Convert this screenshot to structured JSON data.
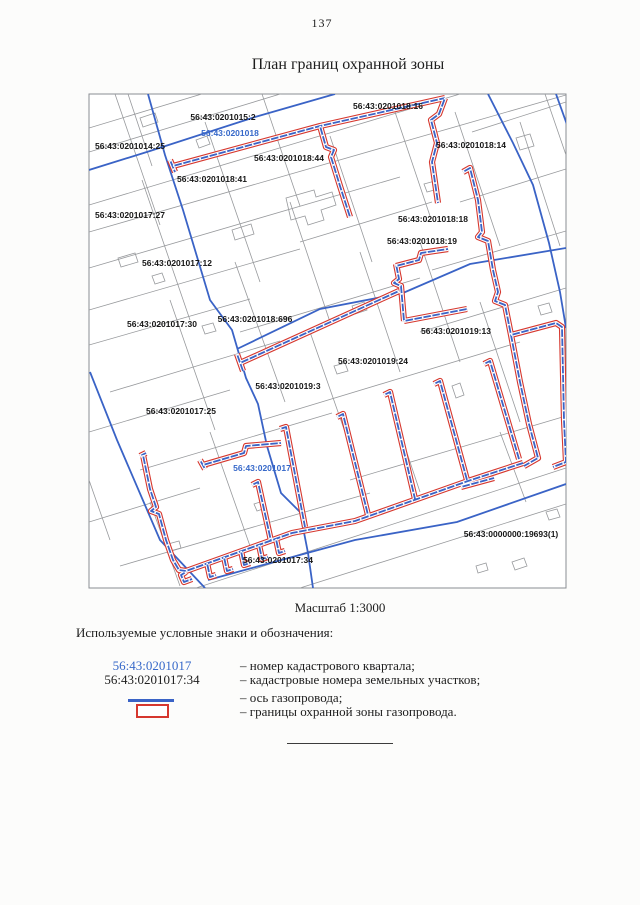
{
  "page": {
    "number": "137",
    "title": "План границ охранной зоны",
    "scale_caption": "Масштаб 1:3000",
    "legend_heading": "Используемые условные знаки и обозначения:"
  },
  "colors": {
    "protection_zone_red": "#d6372e",
    "pipeline_axis_blue": "#3a63c6",
    "quarter_boundary_blue": "#3a63c6",
    "quarter_label_blue": "#3668c9",
    "parcel_line_gray": "#97999c",
    "text_black": "#1d1d1d"
  },
  "map": {
    "labels": [
      {
        "text": "56:43:0201015:2",
        "kind": "parcel"
      },
      {
        "text": "56:43:0201018",
        "kind": "quarter"
      },
      {
        "text": "56:43:0201014:25",
        "kind": "parcel"
      },
      {
        "text": "56:43:0201018:44",
        "kind": "parcel"
      },
      {
        "text": "56:43:0201018:41",
        "kind": "parcel"
      },
      {
        "text": "56:43:0201018:16",
        "kind": "parcel"
      },
      {
        "text": "56:43:0201018:14",
        "kind": "parcel"
      },
      {
        "text": "56:43:0201017:27",
        "kind": "parcel"
      },
      {
        "text": "56:43:0201017:12",
        "kind": "parcel"
      },
      {
        "text": "56:43:0201018:18",
        "kind": "parcel"
      },
      {
        "text": "56:43:0201018:19",
        "kind": "parcel"
      },
      {
        "text": "56:43:0201017:30",
        "kind": "parcel"
      },
      {
        "text": "56:43:0201018:696",
        "kind": "parcel"
      },
      {
        "text": "56:43:0201019:13",
        "kind": "parcel"
      },
      {
        "text": "56:43:0201019:24",
        "kind": "parcel"
      },
      {
        "text": "56:43:0201019:3",
        "kind": "parcel"
      },
      {
        "text": "56:43:0201017:25",
        "kind": "parcel"
      },
      {
        "text": "56:43:0201017",
        "kind": "quarter"
      },
      {
        "text": "56:43:0000000:19693(1)",
        "kind": "parcel"
      },
      {
        "text": "56:43:0201017:34",
        "kind": "parcel"
      }
    ]
  },
  "legend": {
    "rows": [
      {
        "symbol": "quarter-number-sample",
        "symbol_label": "56:43:0201017",
        "desc": "– номер кадастрового квартала;"
      },
      {
        "symbol": "parcel-number-sample",
        "symbol_label": "56:43:0201017:34",
        "desc": "– кадастровые номера земельных участков;"
      },
      {
        "symbol": "axis-line",
        "symbol_label": "",
        "desc": "– ось газопровода;"
      },
      {
        "symbol": "zone-rect",
        "symbol_label": "",
        "desc": "– границы охранной зоны газопровода."
      }
    ]
  }
}
